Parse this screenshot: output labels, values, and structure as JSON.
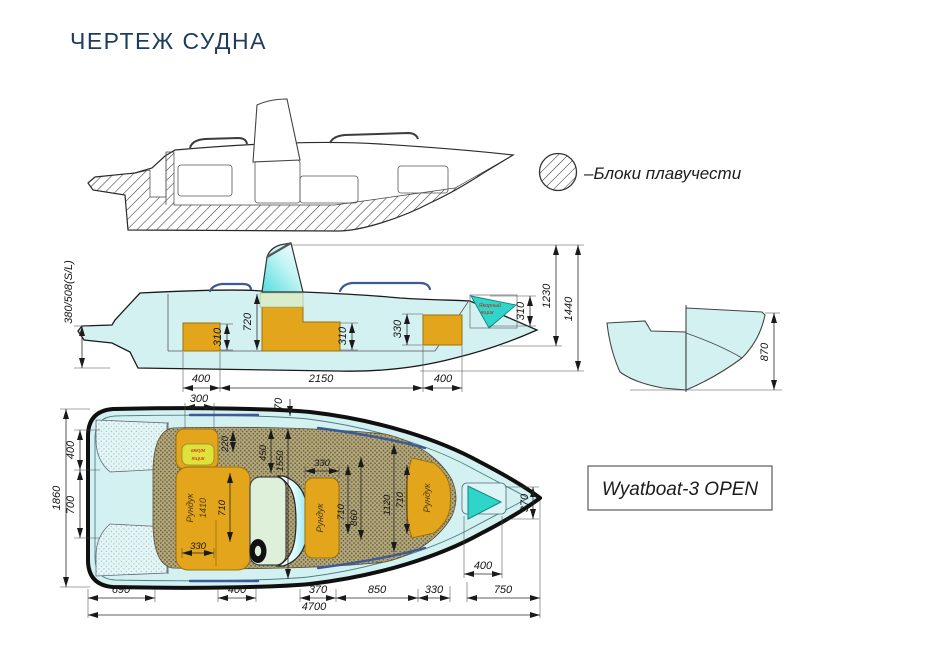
{
  "title": "ЧЕРТЕЖ СУДНА",
  "legend": {
    "label": "–Блоки плавучести"
  },
  "model_box": {
    "label": "Wyatboat-3 OPEN"
  },
  "side_view": {
    "freeboard_label": "380/508(S/L)",
    "anchor_line1": "Якорный",
    "anchor_line2": "ящик",
    "dim_720": "720",
    "dim_310_block1": "310",
    "dim_310_block2": "310",
    "dim_330_block3": "330",
    "dim_310_anchor": "310",
    "dim_1230": "1230",
    "dim_1440": "1440",
    "dim_400_aft": "400",
    "dim_2150": "2150",
    "dim_400_fwd": "400"
  },
  "transom_view": {
    "dim_870": "870"
  },
  "plan_view": {
    "battery_line1": "аккум",
    "battery_line2": "ящик",
    "aft_locker_label": "Рундук",
    "aft_locker_size": "1410",
    "mid_locker_label": "Рундук",
    "bow_locker_label": "Рундук",
    "dim_300": "300",
    "dim_70": "70",
    "dim_1860": "1860",
    "dim_400_platform": "400",
    "dim_700": "700",
    "dim_220": "220",
    "dim_450": "450",
    "dim_1550": "1550",
    "dim_330_mid_locker": "330",
    "dim_710_aft": "710",
    "dim_330_aft": "330",
    "dim_710_mid": "710",
    "dim_860": "860",
    "dim_1120": "1120",
    "dim_710_bow": "710",
    "dim_370_anchor": "370",
    "dim_400_anchor": "400",
    "dim_690": "690",
    "dim_400_bottom": "400",
    "dim_370_bottom": "370",
    "dim_850": "850",
    "dim_330_bottom": "330",
    "dim_750": "750",
    "dim_4700": "4700"
  },
  "colors": {
    "title_navy": "#1d3c5e",
    "hull_cyan": "#d4f1f2",
    "buoyancy_orange": "#e2a51c",
    "anchor_teal": "#2fd5c8",
    "floor_tan": "#b5a97c",
    "battery_yellow": "#dfe23b",
    "label_red": "#c22418",
    "rail_blue": "#3d5a96"
  }
}
